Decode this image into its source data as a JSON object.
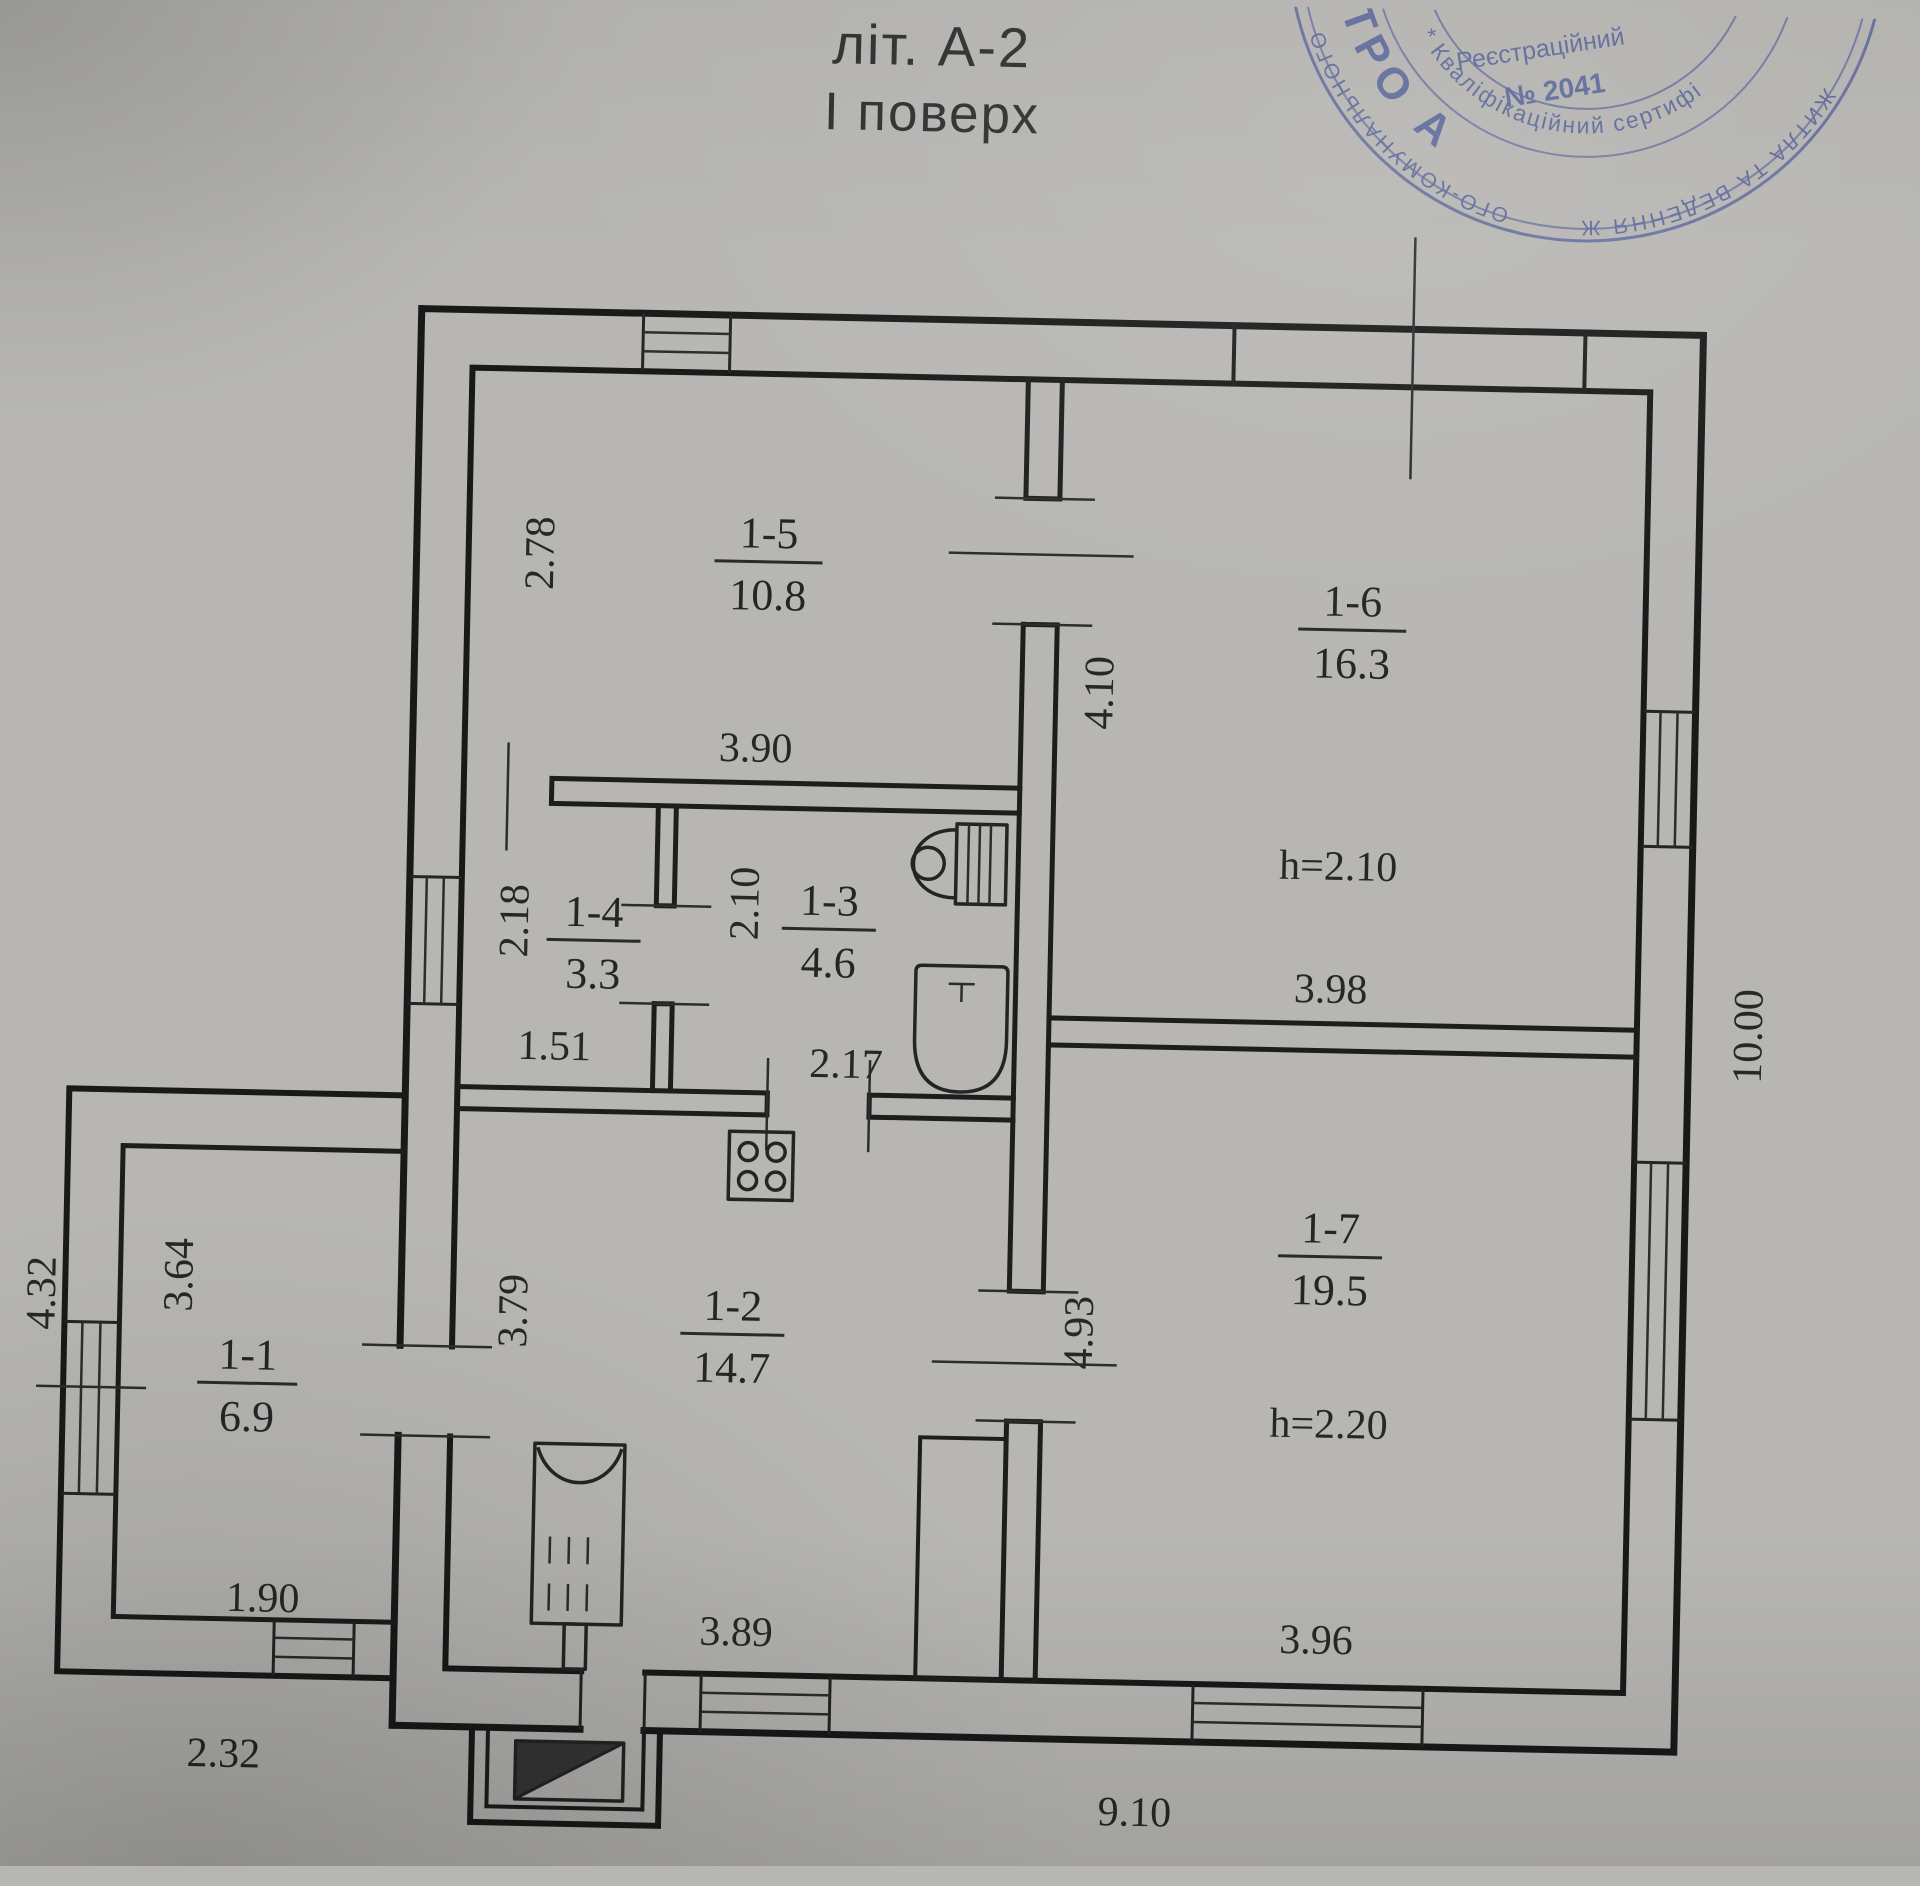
{
  "title": {
    "line1": "літ. А-2",
    "line2": "І поверх"
  },
  "stamp": {
    "color": "#3e4e94",
    "center_line1": "Реєстраційний",
    "center_line2": "№ 2041",
    "name_arc": "ПЛЮК ДМИТРО А",
    "cert_arc": "* Кваліфікаційний сертифіка",
    "outer_arc_left": "ОГО-КОМУНАЛЬНОГО",
    "outer_arc_bottom": "ЖИТЛА ТА ВЕДЕННЯ Ж"
  },
  "rooms": [
    {
      "id": "1-1",
      "area": "6.9"
    },
    {
      "id": "1-2",
      "area": "14.7"
    },
    {
      "id": "1-3",
      "area": "4.6"
    },
    {
      "id": "1-4",
      "area": "3.3"
    },
    {
      "id": "1-5",
      "area": "10.8"
    },
    {
      "id": "1-6",
      "area": "16.3",
      "height": "h=2.10"
    },
    {
      "id": "1-7",
      "area": "19.5",
      "height": "h=2.20"
    }
  ],
  "dims": {
    "v278": "2.78",
    "v390": "3.90",
    "v410": "4.10",
    "v218": "2.18",
    "v151": "1.51",
    "v210": "2.10",
    "v217": "2.17",
    "v398": "3.98",
    "v1000": "10.00",
    "v379": "3.79",
    "v493": "4.93",
    "v432": "4.32",
    "v364": "3.64",
    "v190": "1.90",
    "v232": "2.32",
    "v389": "3.89",
    "v396": "3.96",
    "v910": "9.10"
  }
}
